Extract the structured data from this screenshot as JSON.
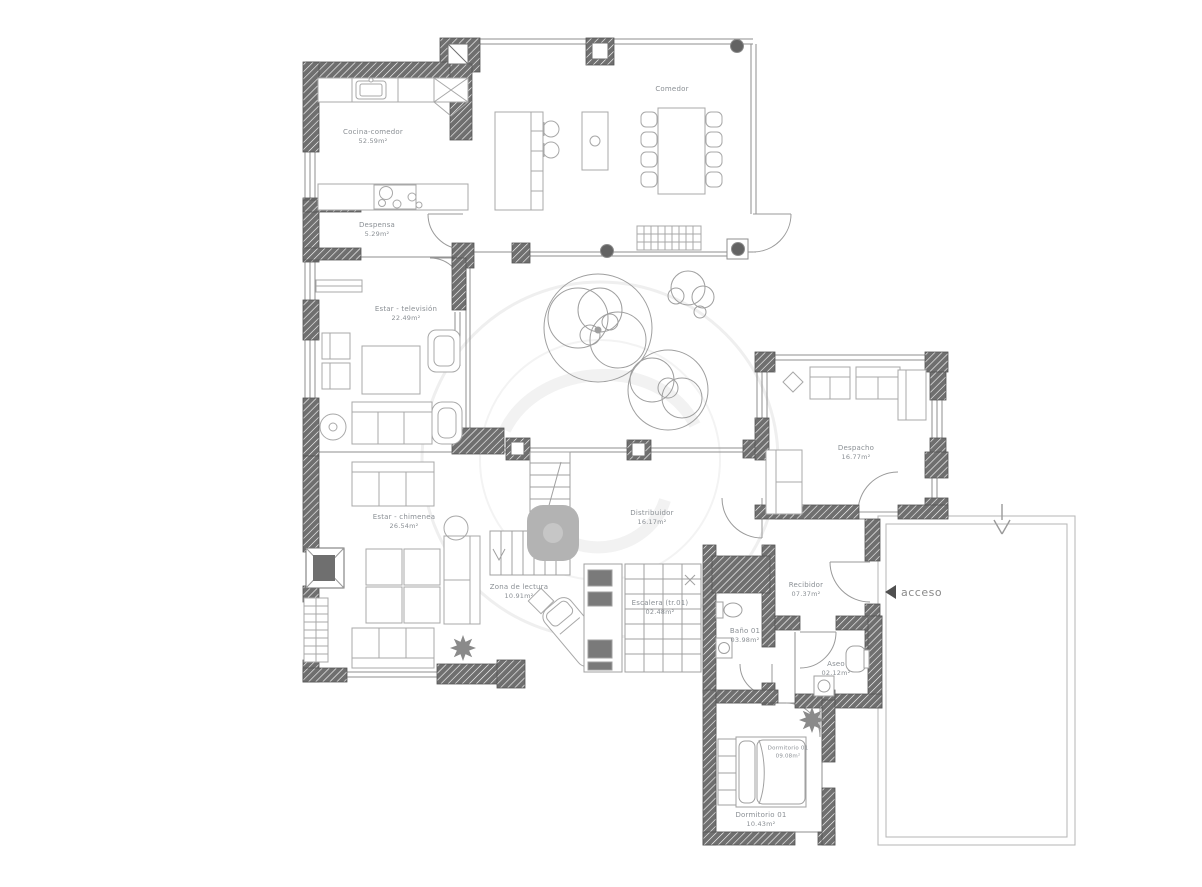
{
  "canvas": {
    "width": 1202,
    "height": 887,
    "background": "#ffffff"
  },
  "colors": {
    "wall_dark": "#6f6f6f",
    "wall_thin": "#8f8f8f",
    "furniture_line": "#a8a8a8",
    "label_text": "#8a8f94",
    "watermark": "#efefef",
    "access_arrow": "#4f4f4f",
    "stair_blob": "#b3b3b3"
  },
  "access": {
    "label": "acceso"
  },
  "rooms": [
    {
      "id": "cocina",
      "label": "Cocina-comedor",
      "area": "52.59m²"
    },
    {
      "id": "comedor",
      "label": "Comedor",
      "area": ""
    },
    {
      "id": "despensa",
      "label": "Despensa",
      "area": "5.29m²"
    },
    {
      "id": "estar_tv",
      "label": "Estar - televisión",
      "area": "22.49m²"
    },
    {
      "id": "estar_chimenea",
      "label": "Estar - chimenea",
      "area": "26.54m²"
    },
    {
      "id": "distribuidor",
      "label": "Distribuidor",
      "area": "16.17m²"
    },
    {
      "id": "despacho",
      "label": "Despacho",
      "area": "16.77m²"
    },
    {
      "id": "recibidor",
      "label": "Recibidor",
      "area": "07.37m²"
    },
    {
      "id": "bano01",
      "label": "Baño 01",
      "area": "03.98m²"
    },
    {
      "id": "aseo",
      "label": "Aseo",
      "area": "02.12m²"
    },
    {
      "id": "zona_lectura",
      "label": "Zona de lectura",
      "area": "10.91m²"
    },
    {
      "id": "escalera",
      "label": "Escalera (tr.01)",
      "area": "02.48m²"
    },
    {
      "id": "dormitorio_tag",
      "label": "Dormitorio 01",
      "area": "09.08m²"
    },
    {
      "id": "dormitorio01",
      "label": "Dormitorio 01",
      "area": "10.43m²"
    }
  ]
}
